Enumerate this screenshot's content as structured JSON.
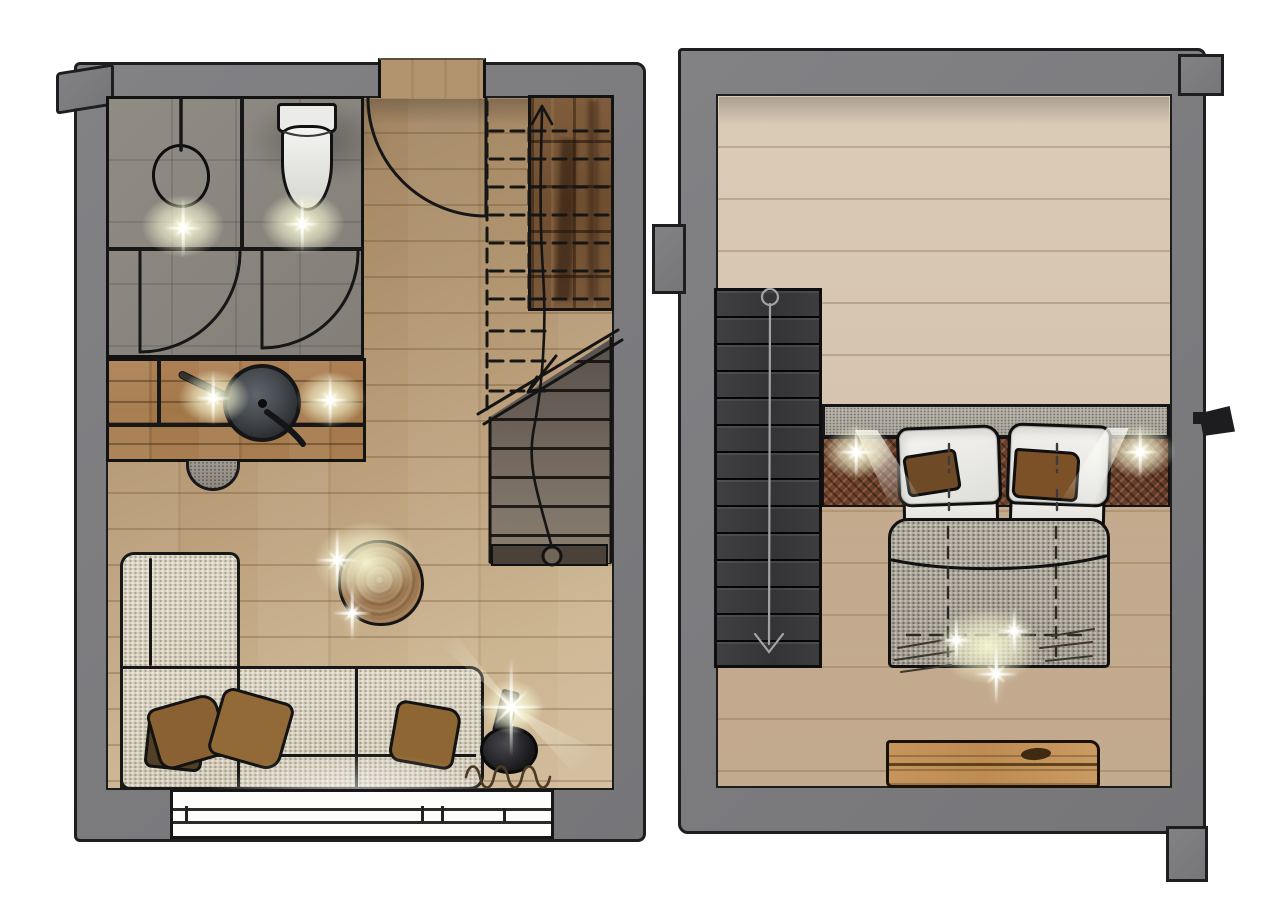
{
  "page": {
    "background": "#ffffff",
    "description": "Hand-drawn interior floor plan illustration with two plans side by side: ground-floor living space (left) and upper-floor bedroom (right). The drawing contains no text labels."
  },
  "palette": {
    "wall_gray": "#7b7b7d",
    "outline_ink": "#1b1b1d",
    "floor_wood_warm": "#b3946f",
    "floor_wood_pale": "#d6c6b1",
    "bathroom_tile": "#8b8780",
    "counter_wood": "#a27748",
    "stair_dark_wood": "#755335",
    "stair_tread_gray": "#766a5e",
    "stair_charcoal": "#39383a",
    "sofa_fabric": "#d6cfbf",
    "cushion_brown": "#8a6132",
    "duvet_gray": "#aca69b",
    "pillow_white": "#f0efeb",
    "headboard_rust": "#66402b",
    "headboard_shelf": "#b5b1a7",
    "bench_wood": "#c2925c",
    "lamp_black": "#202024",
    "light_glow": "#f6f4d0"
  },
  "ground_floor": {
    "label": "ground-floor-plan",
    "rooms": [
      {
        "name": "bathroom",
        "fixtures": [
          "round-washbasin",
          "faucet",
          "toilet",
          "shower-swing-door",
          "shower-swing-door",
          "ceiling-light",
          "ceiling-light"
        ]
      },
      {
        "name": "kitchen",
        "fixtures": [
          "wood-counter",
          "round-cooktop-pan",
          "pan-handle",
          "knife",
          "half-round-stool",
          "ceiling-light",
          "ceiling-light"
        ]
      },
      {
        "name": "living-area",
        "furniture": [
          "l-shaped-sofa",
          "throw-cushion",
          "throw-cushion",
          "throw-cushion",
          "tree-trunk-side-table",
          "floor-lamp",
          "curtain-squiggle"
        ],
        "openings": [
          "entrance-door-swing",
          "sliding-terrace-window"
        ]
      },
      {
        "name": "staircase",
        "elements": [
          "upper-flight-dashed-outline",
          "dark-wood-upper-flight",
          "lower-flight-treads",
          "walking-line-with-arrow",
          "cut-line-with-arrow",
          "landing-strip"
        ]
      }
    ]
  },
  "upper_floor": {
    "label": "upper-floor-plan",
    "rooms": [
      {
        "name": "bedroom",
        "furniture": [
          "double-bed",
          "pillow",
          "pillow",
          "pillow",
          "pillow",
          "throw-cushion",
          "throw-cushion",
          "gray-duvet",
          "headboard-shelf",
          "rust-wall-panel",
          "wood-bench",
          "exterior-wall-lamp"
        ],
        "elements": [
          "charcoal-staircase",
          "walking-line-with-arrow",
          "wall-niche",
          "top-wall-cap",
          "bottom-wall-foot"
        ]
      }
    ]
  },
  "lighting": {
    "ground_floor_glow_count": 6,
    "upper_floor_bedside_lights": 2,
    "upper_floor_foot_of_bed_sparkles": 3
  }
}
